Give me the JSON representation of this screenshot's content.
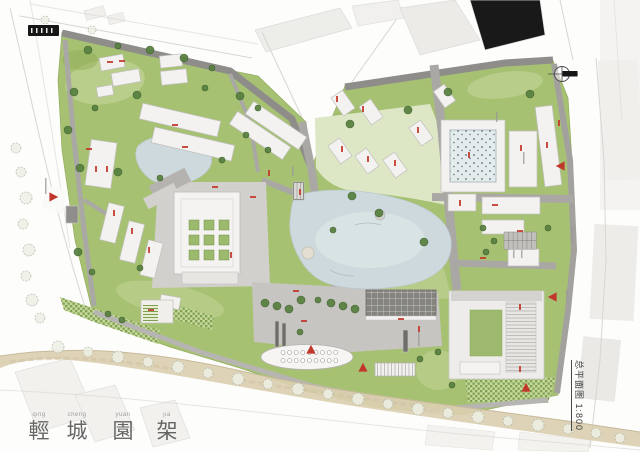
{
  "page": {
    "width": 640,
    "height": 452
  },
  "titleblock": {
    "scale_label": "总平面图 1:800"
  },
  "watermark": [
    {
      "char": "輕",
      "pinyin": "qing"
    },
    {
      "char": "城",
      "pinyin": "cheng"
    },
    {
      "char": "園",
      "pinyin": "yuan"
    },
    {
      "char": "架",
      "pinyin": "jia"
    }
  ],
  "colors": {
    "lawn": "#a7c173",
    "lawn_light": "#c5d59a",
    "lawn_pale": "#dde7c6",
    "water": "#cdd9dc",
    "water_light": "#e0e9ea",
    "road_dark": "#8e8d8a",
    "road_mid": "#aaa8a5",
    "plaza": "#c7c5c1",
    "plaza_light": "#d2d0cc",
    "building_fill": "#f3f2f0",
    "building_stroke": "#c1c0bd",
    "context_fill": "#ecebe8",
    "sand": "#dbcfb0",
    "tree_dark": "#567f3e",
    "marker_red": "#c2372b",
    "ink": "#4f4f4f"
  },
  "map": {
    "buildings": [
      [
        100,
        56,
        24,
        13,
        -10
      ],
      [
        112,
        71,
        28,
        13,
        -10
      ],
      [
        97,
        86,
        16,
        10,
        -10
      ],
      [
        160,
        55,
        22,
        12,
        -6
      ],
      [
        161,
        70,
        26,
        14,
        -6
      ],
      [
        88,
        141,
        26,
        46,
        8
      ],
      [
        140,
        112,
        80,
        16,
        13
      ],
      [
        152,
        136,
        82,
        16,
        13
      ],
      [
        104,
        204,
        16,
        38,
        14
      ],
      [
        124,
        222,
        16,
        40,
        14
      ],
      [
        144,
        241,
        15,
        36,
        14
      ],
      [
        66,
        206,
        12,
        17,
        0,
        "#8f8e8b"
      ],
      [
        228,
        128,
        64,
        15,
        34
      ],
      [
        244,
        118,
        64,
        15,
        34
      ],
      [
        336,
        92,
        14,
        22,
        -35
      ],
      [
        364,
        101,
        14,
        22,
        -35
      ],
      [
        333,
        140,
        14,
        22,
        -35
      ],
      [
        360,
        150,
        14,
        22,
        -35
      ],
      [
        388,
        154,
        14,
        22,
        -35
      ],
      [
        414,
        122,
        14,
        22,
        -35
      ],
      [
        438,
        86,
        13,
        20,
        -35
      ],
      [
        441,
        120,
        64,
        72,
        0
      ],
      [
        509,
        131,
        28,
        56,
        0
      ],
      [
        540,
        106,
        17,
        80,
        -7
      ],
      [
        448,
        194,
        28,
        17,
        0
      ],
      [
        482,
        197,
        58,
        17,
        0
      ],
      [
        482,
        220,
        42,
        14,
        0
      ],
      [
        508,
        249,
        31,
        17,
        0
      ],
      [
        160,
        296,
        20,
        12,
        10
      ],
      [
        275,
        321,
        4,
        26,
        0,
        "#6e6d6a"
      ],
      [
        282,
        323,
        4,
        26,
        0,
        "#6e6d6a"
      ],
      [
        403,
        330,
        5,
        22,
        0,
        "#6e6d6a"
      ],
      [
        293,
        182,
        11,
        18,
        0,
        "#77756f"
      ]
    ],
    "trees_solid": [
      [
        88,
        50,
        4
      ],
      [
        118,
        46,
        3
      ],
      [
        150,
        50,
        4
      ],
      [
        184,
        58,
        4
      ],
      [
        212,
        68,
        3
      ],
      [
        74,
        92,
        4
      ],
      [
        95,
        108,
        3
      ],
      [
        137,
        95,
        4
      ],
      [
        205,
        88,
        3
      ],
      [
        240,
        96,
        4
      ],
      [
        258,
        108,
        3
      ],
      [
        68,
        130,
        4
      ],
      [
        80,
        168,
        4
      ],
      [
        118,
        172,
        4
      ],
      [
        160,
        178,
        3
      ],
      [
        222,
        160,
        3
      ],
      [
        78,
        252,
        4
      ],
      [
        92,
        272,
        3
      ],
      [
        140,
        268,
        3
      ],
      [
        108,
        314,
        3
      ],
      [
        122,
        320,
        3
      ],
      [
        350,
        124,
        4
      ],
      [
        408,
        110,
        4
      ],
      [
        448,
        92,
        4
      ],
      [
        530,
        94,
        4
      ],
      [
        352,
        196,
        4
      ],
      [
        379,
        213,
        4
      ],
      [
        424,
        242,
        4
      ],
      [
        333,
        230,
        3
      ],
      [
        483,
        228,
        3
      ],
      [
        494,
        241,
        3
      ],
      [
        486,
        252,
        3
      ],
      [
        548,
        228,
        3
      ],
      [
        265,
        303,
        4
      ],
      [
        277,
        306,
        4
      ],
      [
        289,
        309,
        4
      ],
      [
        301,
        300,
        4
      ],
      [
        331,
        303,
        4
      ],
      [
        343,
        306,
        4
      ],
      [
        355,
        309,
        4
      ],
      [
        420,
        359,
        3
      ],
      [
        438,
        352,
        3
      ],
      [
        452,
        385,
        3
      ],
      [
        300,
        332,
        3
      ],
      [
        318,
        300,
        3
      ],
      [
        246,
        135,
        3
      ],
      [
        268,
        150,
        3
      ]
    ],
    "trees_sketch": [
      [
        16,
        148,
        5
      ],
      [
        21,
        172,
        5
      ],
      [
        26,
        198,
        6
      ],
      [
        23,
        224,
        5
      ],
      [
        29,
        250,
        6
      ],
      [
        26,
        276,
        5
      ],
      [
        32,
        300,
        6
      ],
      [
        40,
        318,
        5
      ],
      [
        58,
        347,
        6
      ],
      [
        88,
        352,
        5
      ],
      [
        118,
        357,
        6
      ],
      [
        148,
        362,
        5
      ],
      [
        178,
        367,
        6
      ],
      [
        208,
        373,
        5
      ],
      [
        238,
        379,
        6
      ],
      [
        268,
        384,
        5
      ],
      [
        298,
        389,
        6
      ],
      [
        328,
        394,
        5
      ],
      [
        358,
        399,
        6
      ],
      [
        388,
        404,
        5
      ],
      [
        418,
        409,
        6
      ],
      [
        448,
        413,
        5
      ],
      [
        478,
        417,
        6
      ],
      [
        508,
        421,
        5
      ],
      [
        538,
        425,
        6
      ],
      [
        568,
        429,
        5
      ],
      [
        596,
        433,
        5
      ],
      [
        45,
        20,
        4
      ],
      [
        92,
        30,
        4
      ],
      [
        620,
        438,
        5
      ]
    ],
    "entrances": [
      [
        53,
        197,
        90
      ],
      [
        311,
        350,
        0
      ],
      [
        363,
        368,
        0
      ],
      [
        526,
        388,
        0
      ],
      [
        561,
        166,
        -90
      ],
      [
        553,
        297,
        -90
      ]
    ],
    "red_marks": [
      [
        107,
        61,
        0
      ],
      [
        119,
        60,
        0
      ],
      [
        95,
        166,
        1
      ],
      [
        106,
        166,
        1
      ],
      [
        172,
        124,
        0
      ],
      [
        182,
        146,
        0
      ],
      [
        113,
        210,
        1
      ],
      [
        131,
        228,
        1
      ],
      [
        148,
        247,
        1
      ],
      [
        212,
        186,
        0
      ],
      [
        250,
        196,
        0
      ],
      [
        268,
        170,
        1
      ],
      [
        299,
        189,
        1
      ],
      [
        341,
        146,
        1
      ],
      [
        367,
        156,
        1
      ],
      [
        394,
        160,
        1
      ],
      [
        417,
        127,
        1
      ],
      [
        468,
        152,
        1
      ],
      [
        520,
        145,
        1
      ],
      [
        546,
        142,
        1
      ],
      [
        459,
        200,
        1
      ],
      [
        492,
        204,
        0
      ],
      [
        517,
        230,
        0
      ],
      [
        301,
        320,
        0
      ],
      [
        418,
        326,
        1
      ],
      [
        519,
        304,
        1
      ],
      [
        519,
        366,
        1
      ],
      [
        480,
        257,
        0
      ],
      [
        148,
        309,
        0
      ],
      [
        230,
        252,
        1
      ],
      [
        86,
        148,
        0
      ],
      [
        293,
        290,
        0
      ],
      [
        398,
        318,
        0
      ],
      [
        558,
        120,
        1
      ],
      [
        336,
        96,
        1
      ],
      [
        362,
        106,
        1
      ]
    ],
    "gray_marks": [
      [
        45,
        178,
        16
      ],
      [
        571,
        226,
        16
      ],
      [
        566,
        290,
        12
      ],
      [
        523,
        152,
        12
      ],
      [
        513,
        250,
        8
      ],
      [
        521,
        250,
        8
      ],
      [
        292,
        166,
        10
      ],
      [
        496,
        112,
        10
      ],
      [
        418,
        332,
        14
      ]
    ],
    "courtyard_grid": {
      "x": 189,
      "y": 220,
      "rows": 3,
      "cols": 3,
      "size": 10,
      "step": 15
    },
    "parking": {
      "x": 504,
      "y": 232,
      "cols": 7,
      "rows": 2,
      "cw": 4.6,
      "ch": 8.6
    },
    "oval_dots": {
      "x0": 283,
      "step": 6.6,
      "count": 9,
      "rows": [
        352.5,
        360.5
      ],
      "r": 2
    }
  }
}
